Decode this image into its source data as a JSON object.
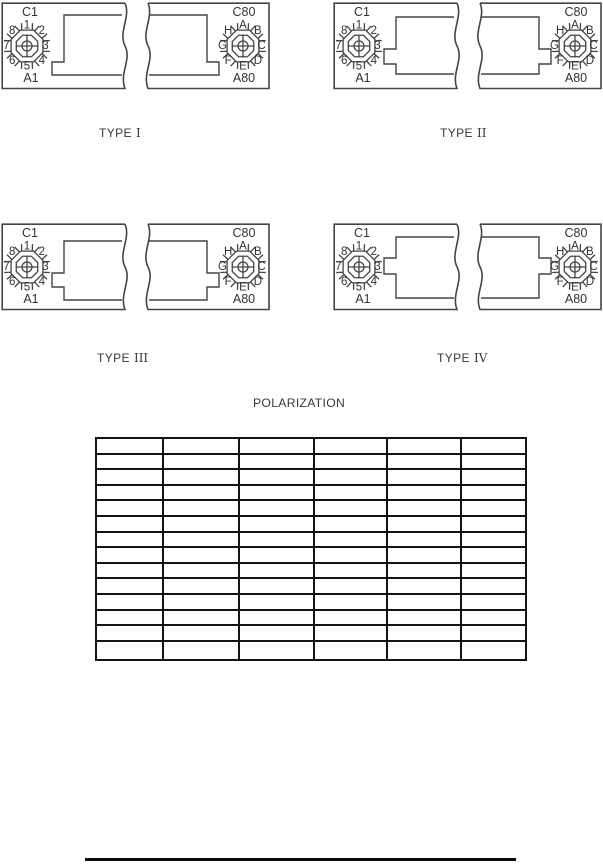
{
  "page": {
    "background": "#ffffff",
    "line_color": "#454545",
    "text_color": "#383838",
    "table_border_color": "#141414"
  },
  "diagrams": [
    {
      "label_word": "TYPE",
      "numeral": "I",
      "key_style": "step-bottom",
      "left": {
        "top_label": "C1",
        "bottom_label": "A1",
        "positions": [
          "1",
          "2",
          "3",
          "4",
          "5",
          "6",
          "7",
          "8"
        ]
      },
      "right": {
        "top_label": "C80",
        "bottom_label": "A80",
        "positions": [
          "A",
          "B",
          "C",
          "D",
          "E",
          "F",
          "G",
          "H"
        ]
      }
    },
    {
      "label_word": "TYPE",
      "numeral": "II",
      "key_style": "notch-below-center",
      "left": {
        "top_label": "C1",
        "bottom_label": "A1",
        "positions": [
          "1",
          "2",
          "3",
          "4",
          "5",
          "6",
          "7",
          "8"
        ]
      },
      "right": {
        "top_label": "C80",
        "bottom_label": "A80",
        "positions": [
          "A",
          "B",
          "C",
          "D",
          "E",
          "F",
          "G",
          "H"
        ]
      }
    },
    {
      "label_word": "TYPE",
      "numeral": "III",
      "key_style": "notch-low",
      "left": {
        "top_label": "C1",
        "bottom_label": "A1",
        "positions": [
          "1",
          "2",
          "3",
          "4",
          "5",
          "6",
          "7",
          "8"
        ]
      },
      "right": {
        "top_label": "C80",
        "bottom_label": "A80",
        "positions": [
          "A",
          "B",
          "C",
          "D",
          "E",
          "F",
          "G",
          "H"
        ]
      }
    },
    {
      "label_word": "TYPE",
      "numeral": "IV",
      "key_style": "notch-center",
      "left": {
        "top_label": "C1",
        "bottom_label": "A1",
        "positions": [
          "1",
          "2",
          "3",
          "4",
          "5",
          "6",
          "7",
          "8"
        ]
      },
      "right": {
        "top_label": "C80",
        "bottom_label": "A80",
        "positions": [
          "A",
          "B",
          "C",
          "D",
          "E",
          "F",
          "G",
          "H"
        ]
      }
    }
  ],
  "polarization_table": {
    "title": "POLARIZATION",
    "rows": 14,
    "columns": 6,
    "all_cells_empty": true
  }
}
